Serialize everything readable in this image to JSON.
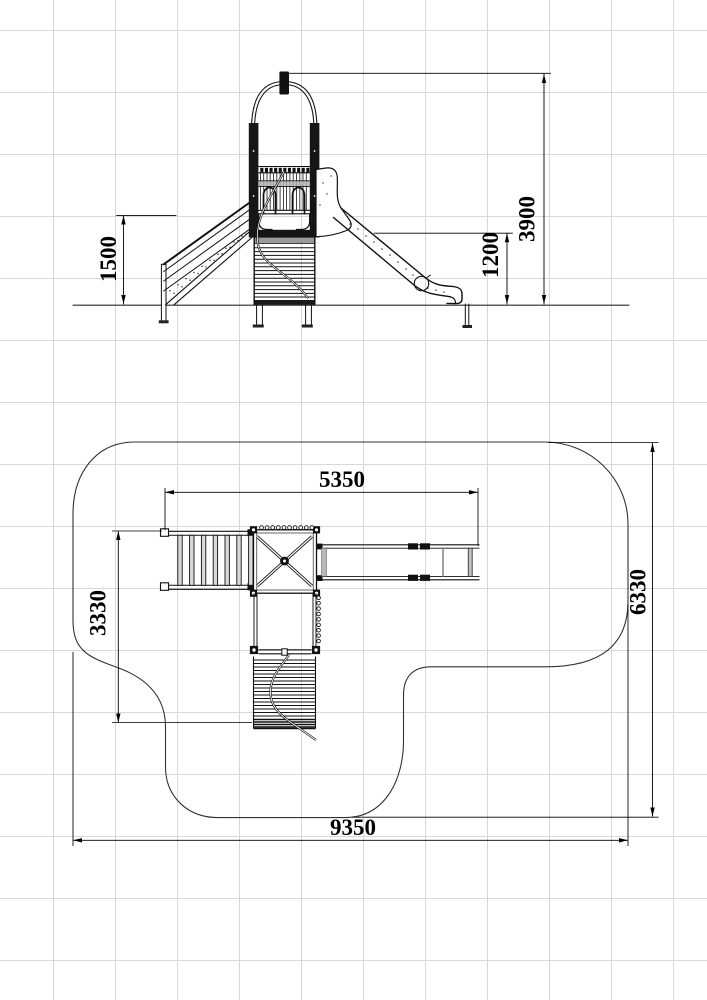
{
  "drawing": {
    "type": "playground-equipment-technical-drawing",
    "views": [
      "side-elevation",
      "plan-view"
    ]
  },
  "colors": {
    "line": "#111111",
    "grid": "#d8d8d8",
    "gray_fill": "#b3b3b3",
    "ground": "#2a2a2a"
  },
  "dims": {
    "rail_height": "1500",
    "total_height": "3900",
    "deck_height": "1200",
    "equipment_length": "5350",
    "equipment_depth": "3330",
    "safety_zone_depth": "6330",
    "safety_zone_length": "9350"
  }
}
